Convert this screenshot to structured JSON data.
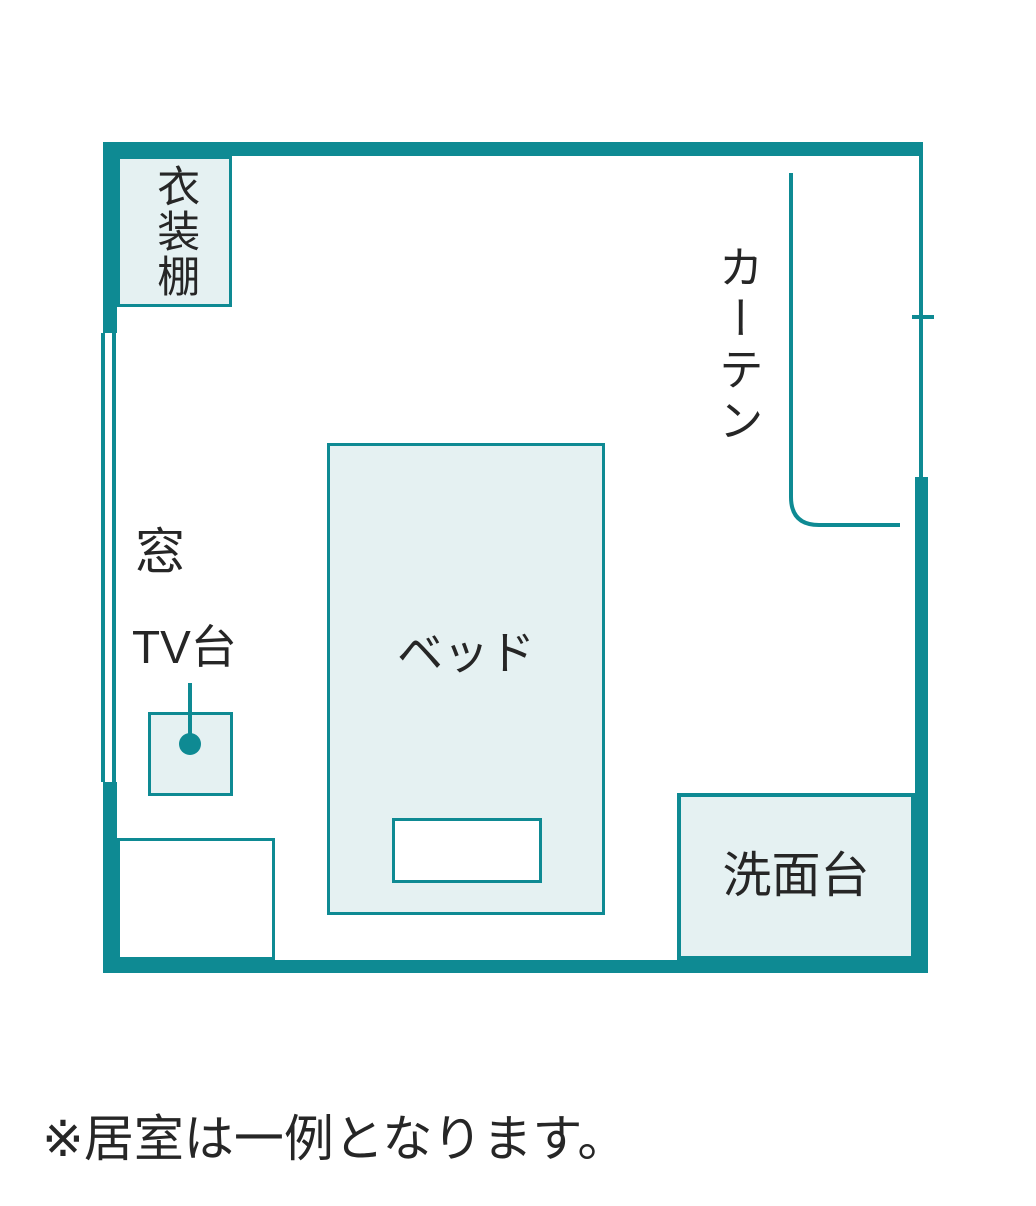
{
  "note": "※居室は一例となります。",
  "labels": {
    "wardrobe": "衣装棚",
    "curtain": "カーテン",
    "window": "窓",
    "tv_stand": "TV台",
    "bed": "ベッド",
    "washstand": "洗面台"
  },
  "colors": {
    "wall": "#0e8a93",
    "furniture_fill": "#e5f1f2",
    "label_text": "#262626",
    "background": "#ffffff"
  }
}
